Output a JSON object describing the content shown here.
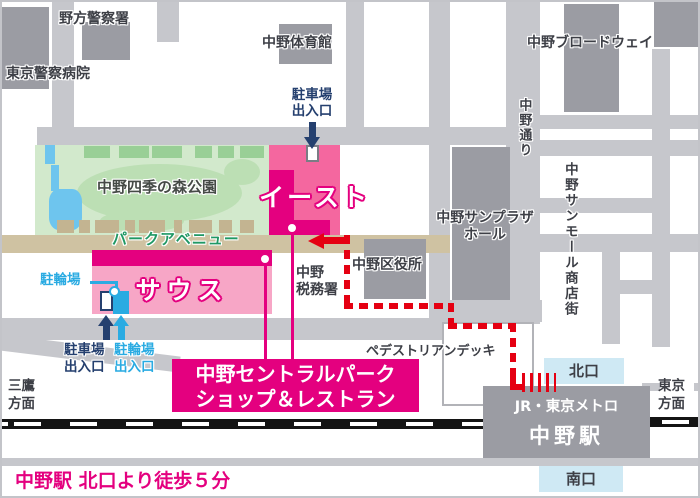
{
  "colors": {
    "brand_pink": "#e4007f",
    "east_fill": "#f4679f",
    "south_fill": "#f7a6c6",
    "route_red": "#e50012",
    "navy": "#25406f",
    "cyan": "#2aabe2",
    "road_gray": "#c6c7cc",
    "building_gray": "#9b9ca3",
    "park_green": "#d2e9cc",
    "avenue_tan": "#cfc2a2",
    "exit_box_blue": "#cfe9f4",
    "water_blue": "#6ec5ee"
  },
  "labels": {
    "nogata_police": "野方警察署",
    "police_hospital": "東京警察病院",
    "gymnasium": "中野体育館",
    "broadway": "中野ブロードウェイ",
    "nakano_dori": "中野通り",
    "sunmall": "中野サンモール商店街",
    "sunplaza_l1": "中野サンプラザ",
    "sunplaza_l2": "ホール",
    "ward_office": "中野区役所",
    "tax_office_l1": "中野",
    "tax_office_l2": "税務署",
    "park_name": "中野四季の森公園",
    "park_avenue": "パークアベニュー",
    "east": "イースト",
    "south": "サウス",
    "east_parking_l1": "駐車場",
    "east_parking_l2": "出入口",
    "bicycle_tag": "駐輪場",
    "south_parking_l1": "駐車場",
    "south_parking_l2": "出入口",
    "south_bicycle_l1": "駐輪場",
    "south_bicycle_l2": "出入口",
    "pedestrian_deck": "ペデストリアンデッキ",
    "mitaka_l1": "三鷹",
    "mitaka_l2": "方面",
    "tokyo_l1": "東京",
    "tokyo_l2": "方面"
  },
  "station": {
    "north_exit": "北口",
    "south_exit": "南口",
    "operator": "JR・東京メトロ",
    "name": "中野駅"
  },
  "callout": {
    "line1": "中野セントラルパーク",
    "line2": "ショップ＆レストラン"
  },
  "caption": "中野駅 北口より徒歩５分"
}
